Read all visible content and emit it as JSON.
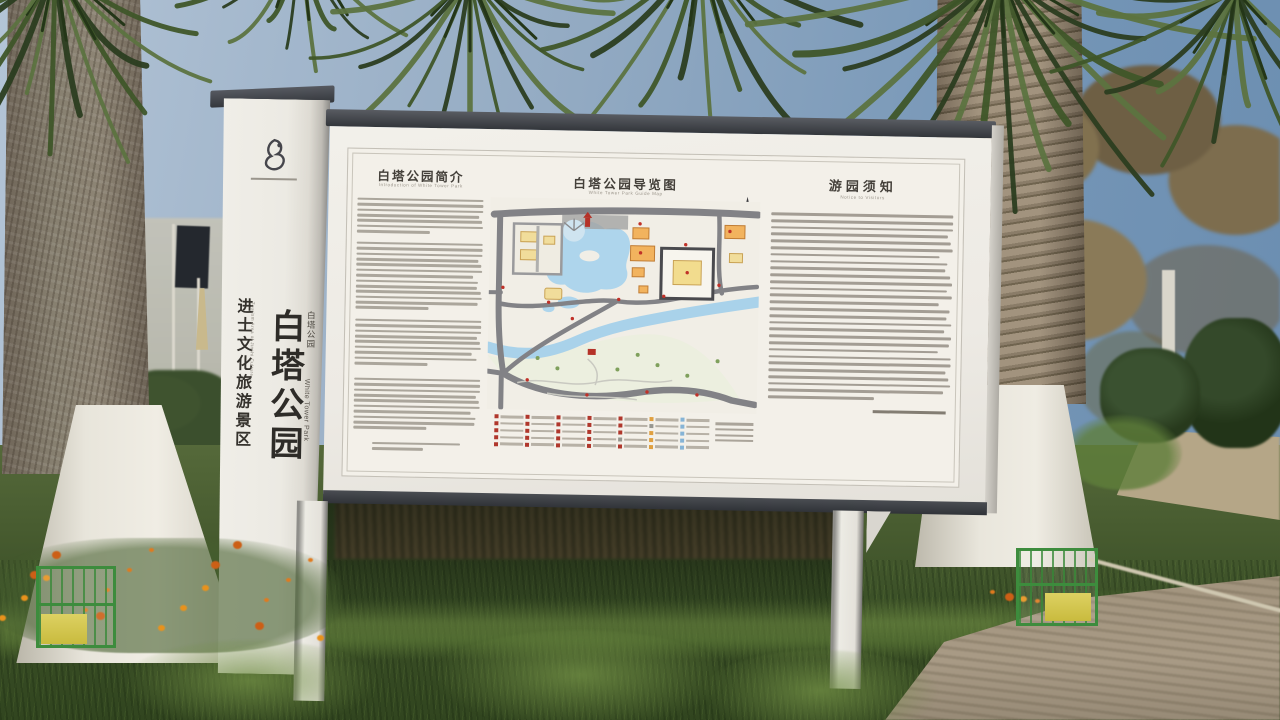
{
  "pillar": {
    "logo_icon": "park-logo-emblem",
    "title": "白塔公园",
    "subtitle_cn": "白塔公园",
    "title_en": "White Tower Park",
    "side_label": "进士文化旅游景区",
    "side_label_en": "Tourism Area of Jinshi Culture"
  },
  "board": {
    "intro": {
      "title": "白塔公园简介",
      "subtitle_en": "Introduction of White Tower Park"
    },
    "map": {
      "title": "白塔公园导览图",
      "subtitle_en": "White Tower Park Guide Map"
    },
    "notice": {
      "title": "游园须知",
      "subtitle_en": "Notice to Visitors"
    }
  },
  "colors": {
    "sky": "#8fa6bc",
    "board_cap": "#3b3e43",
    "board_face": "#efece6",
    "map_water": "#aed5ec",
    "map_road": "#828286",
    "map_building_yellow": "#f1dd9b",
    "map_building_orange": "#f2b35e",
    "map_marker_red": "#b5362c",
    "flowers_orange": "#e07a1e",
    "cage_green": "#3d8c3d",
    "grass_green": "#485c30",
    "trunk_paint_white": "#e9e6dc"
  }
}
